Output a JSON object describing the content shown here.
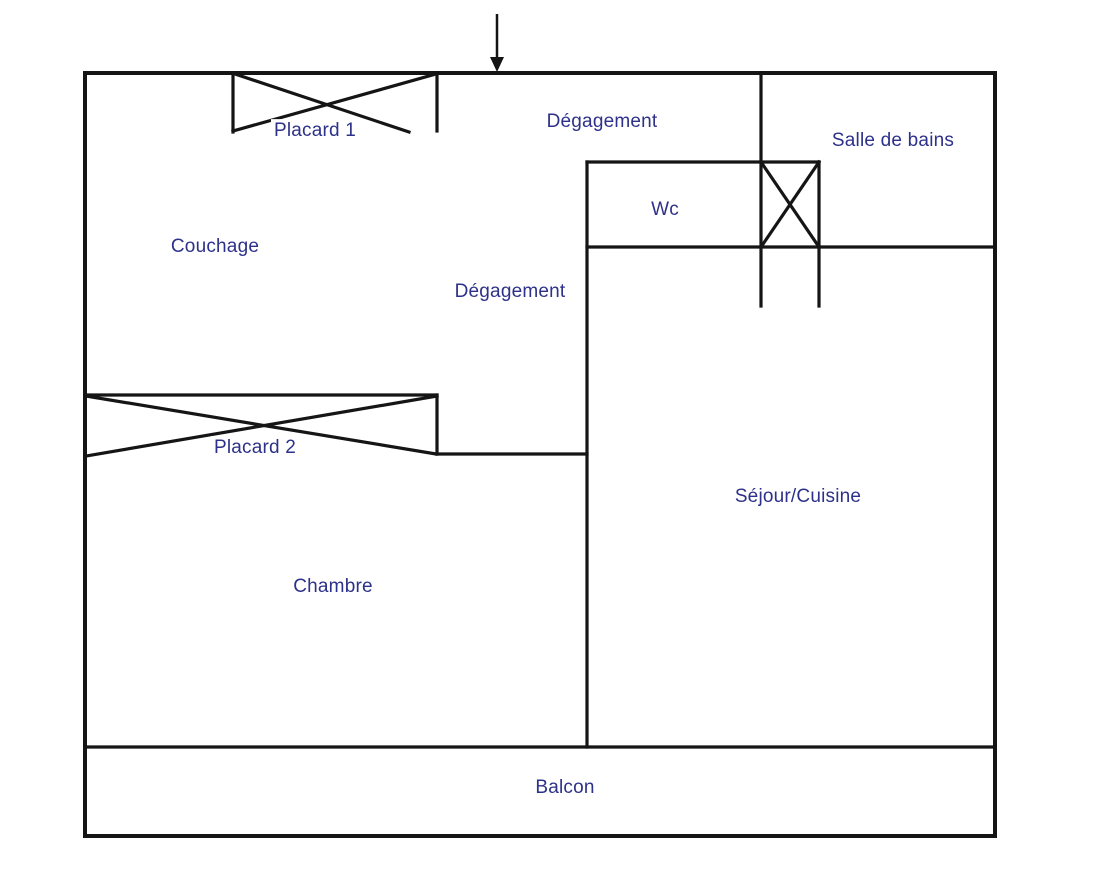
{
  "title": "Plan d'appartement",
  "colors": {
    "background": "#ffffff",
    "wall": "#151515",
    "label": "#2d3189"
  },
  "floorplan": {
    "width": 1093,
    "height": 883,
    "walls": [
      {
        "name": "outer-top-wall",
        "x1": 85,
        "y1": 73,
        "x2": 995,
        "y2": 73,
        "w": 4
      },
      {
        "name": "outer-left-wall",
        "x1": 85,
        "y1": 73,
        "x2": 85,
        "y2": 836,
        "w": 4
      },
      {
        "name": "outer-right-wall",
        "x1": 995,
        "y1": 73,
        "x2": 995,
        "y2": 836,
        "w": 4
      },
      {
        "name": "outer-bottom-wall",
        "x1": 85,
        "y1": 836,
        "x2": 995,
        "y2": 836,
        "w": 4
      },
      {
        "name": "balcony-top-wall",
        "x1": 85,
        "y1": 747,
        "x2": 995,
        "y2": 747,
        "w": 3.2
      },
      {
        "name": "mid-vertical-wall",
        "x1": 587,
        "y1": 162,
        "x2": 587,
        "y2": 747,
        "w": 3.2
      },
      {
        "name": "bath-left-wall",
        "x1": 761,
        "y1": 73,
        "x2": 761,
        "y2": 306,
        "w": 3.2
      },
      {
        "name": "shower-right-wall",
        "x1": 819,
        "y1": 162,
        "x2": 819,
        "y2": 306,
        "w": 3.2
      },
      {
        "name": "wc-top-wall",
        "x1": 587,
        "y1": 162,
        "x2": 819,
        "y2": 162,
        "w": 3.2
      },
      {
        "name": "wc-bath-bottom-wall",
        "x1": 587,
        "y1": 247,
        "x2": 995,
        "y2": 247,
        "w": 3.2
      },
      {
        "name": "chambre-top-wall",
        "x1": 437,
        "y1": 454,
        "x2": 587,
        "y2": 454,
        "w": 3.2
      },
      {
        "name": "placard1-left-edge",
        "x1": 233,
        "y1": 73,
        "x2": 233,
        "y2": 132,
        "w": 3.2
      },
      {
        "name": "placard1-right-edge",
        "x1": 437,
        "y1": 73,
        "x2": 437,
        "y2": 131,
        "w": 3.2
      },
      {
        "name": "placard1-cross-a",
        "x1": 235,
        "y1": 74,
        "x2": 409,
        "y2": 132,
        "w": 3.2
      },
      {
        "name": "placard1-cross-b",
        "x1": 436,
        "y1": 74,
        "x2": 233,
        "y2": 131,
        "w": 3.2
      },
      {
        "name": "placard2-top-edge",
        "x1": 85,
        "y1": 395,
        "x2": 437,
        "y2": 395,
        "w": 3.2
      },
      {
        "name": "placard2-right-edge",
        "x1": 437,
        "y1": 395,
        "x2": 437,
        "y2": 454,
        "w": 3.2
      },
      {
        "name": "placard2-cross-a",
        "x1": 86,
        "y1": 396,
        "x2": 436,
        "y2": 454,
        "w": 3.2
      },
      {
        "name": "placard2-cross-b",
        "x1": 437,
        "y1": 396,
        "x2": 86,
        "y2": 456,
        "w": 3.2
      },
      {
        "name": "shower-cross-a",
        "x1": 761,
        "y1": 162,
        "x2": 819,
        "y2": 247,
        "w": 3.2
      },
      {
        "name": "shower-cross-b",
        "x1": 819,
        "y1": 162,
        "x2": 761,
        "y2": 247,
        "w": 3.2
      }
    ],
    "entrance_arrow": {
      "x": 497,
      "top": 14,
      "shaft_bottom": 60,
      "tip_y": 72,
      "half_width": 7,
      "stroke_width": 2.5
    }
  },
  "rooms": [
    {
      "label": "Placard 1",
      "x": 315,
      "y": 131
    },
    {
      "label": "Dégagement",
      "x": 602,
      "y": 122
    },
    {
      "label": "Salle de bains",
      "x": 893,
      "y": 141
    },
    {
      "label": "Wc",
      "x": 665,
      "y": 210
    },
    {
      "label": "Couchage",
      "x": 215,
      "y": 247
    },
    {
      "label": "Dégagement",
      "x": 510,
      "y": 292
    },
    {
      "label": "Placard 2",
      "x": 255,
      "y": 448
    },
    {
      "label": "Séjour/Cuisine",
      "x": 798,
      "y": 497
    },
    {
      "label": "Chambre",
      "x": 333,
      "y": 587
    },
    {
      "label": "Balcon",
      "x": 565,
      "y": 788
    }
  ]
}
